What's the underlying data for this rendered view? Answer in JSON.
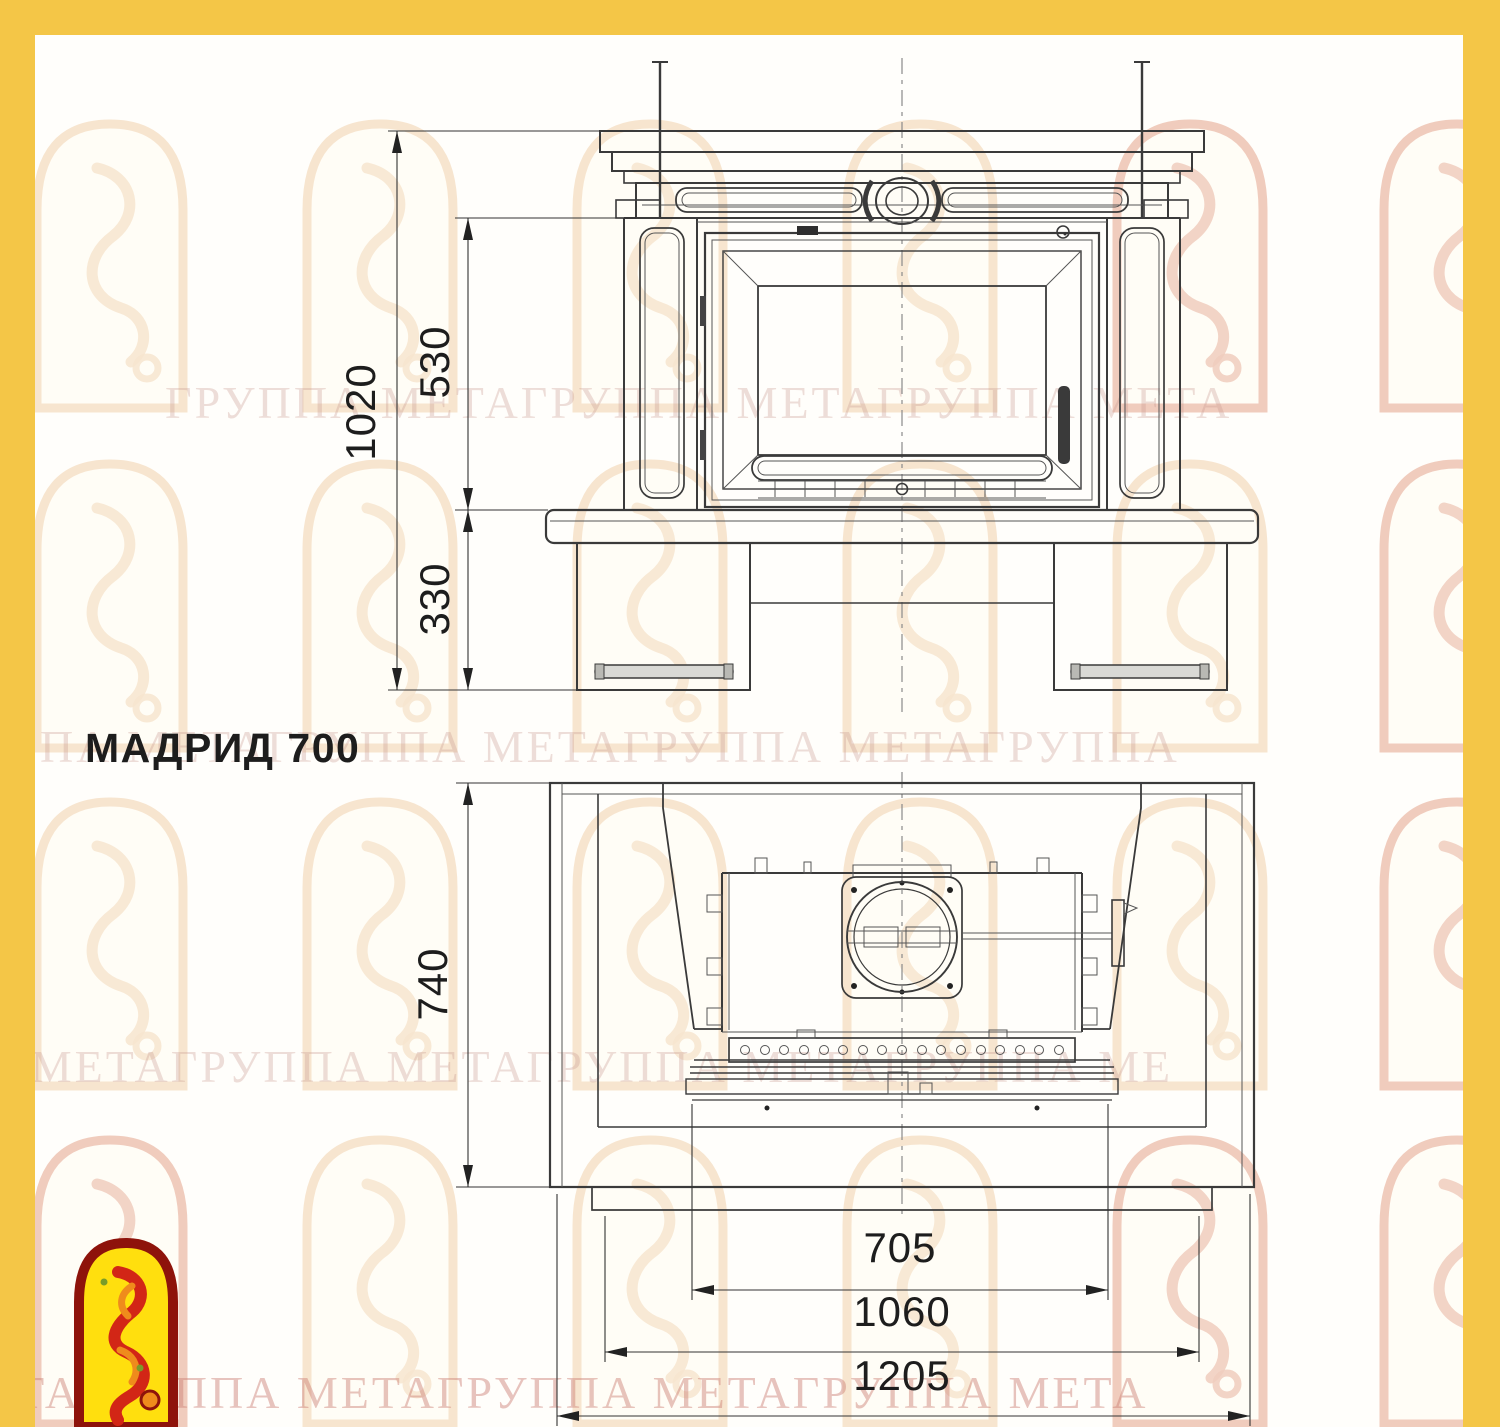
{
  "title": "МАДРИД 700",
  "colors": {
    "frame": "#f4c647",
    "sheet": "#fffefb",
    "drawing_line": "#3a3a3a",
    "logo_red": "#8e130b",
    "logo_yellow": "#ffdf0e",
    "logo_dragon": "#d22616",
    "logo_orange": "#ef8b1c"
  },
  "front_view": {
    "label": "front elevation of fireplace",
    "dims": {
      "overall_height": "1020",
      "opening_height": "530",
      "base_height": "330"
    }
  },
  "plan_view": {
    "label": "top (plan) view of fireplace",
    "dims": {
      "depth": "740",
      "firebox_width": "705",
      "insert_width": "1060",
      "overall_width": "1205"
    }
  },
  "watermark": {
    "rows": [
      "ГРУППА МЕТАГРУППА МЕТАГРУППА МЕТА",
      "ПА МЕТАГРУППА МЕТАГРУППА МЕТАГРУППА",
      "А МЕТАГРУППА МЕТАГРУППА МЕТАГРУППА МЕ",
      "ЕТАГРУППА МЕТАГРУППА МЕТАГРУППА МЕТА"
    ]
  }
}
